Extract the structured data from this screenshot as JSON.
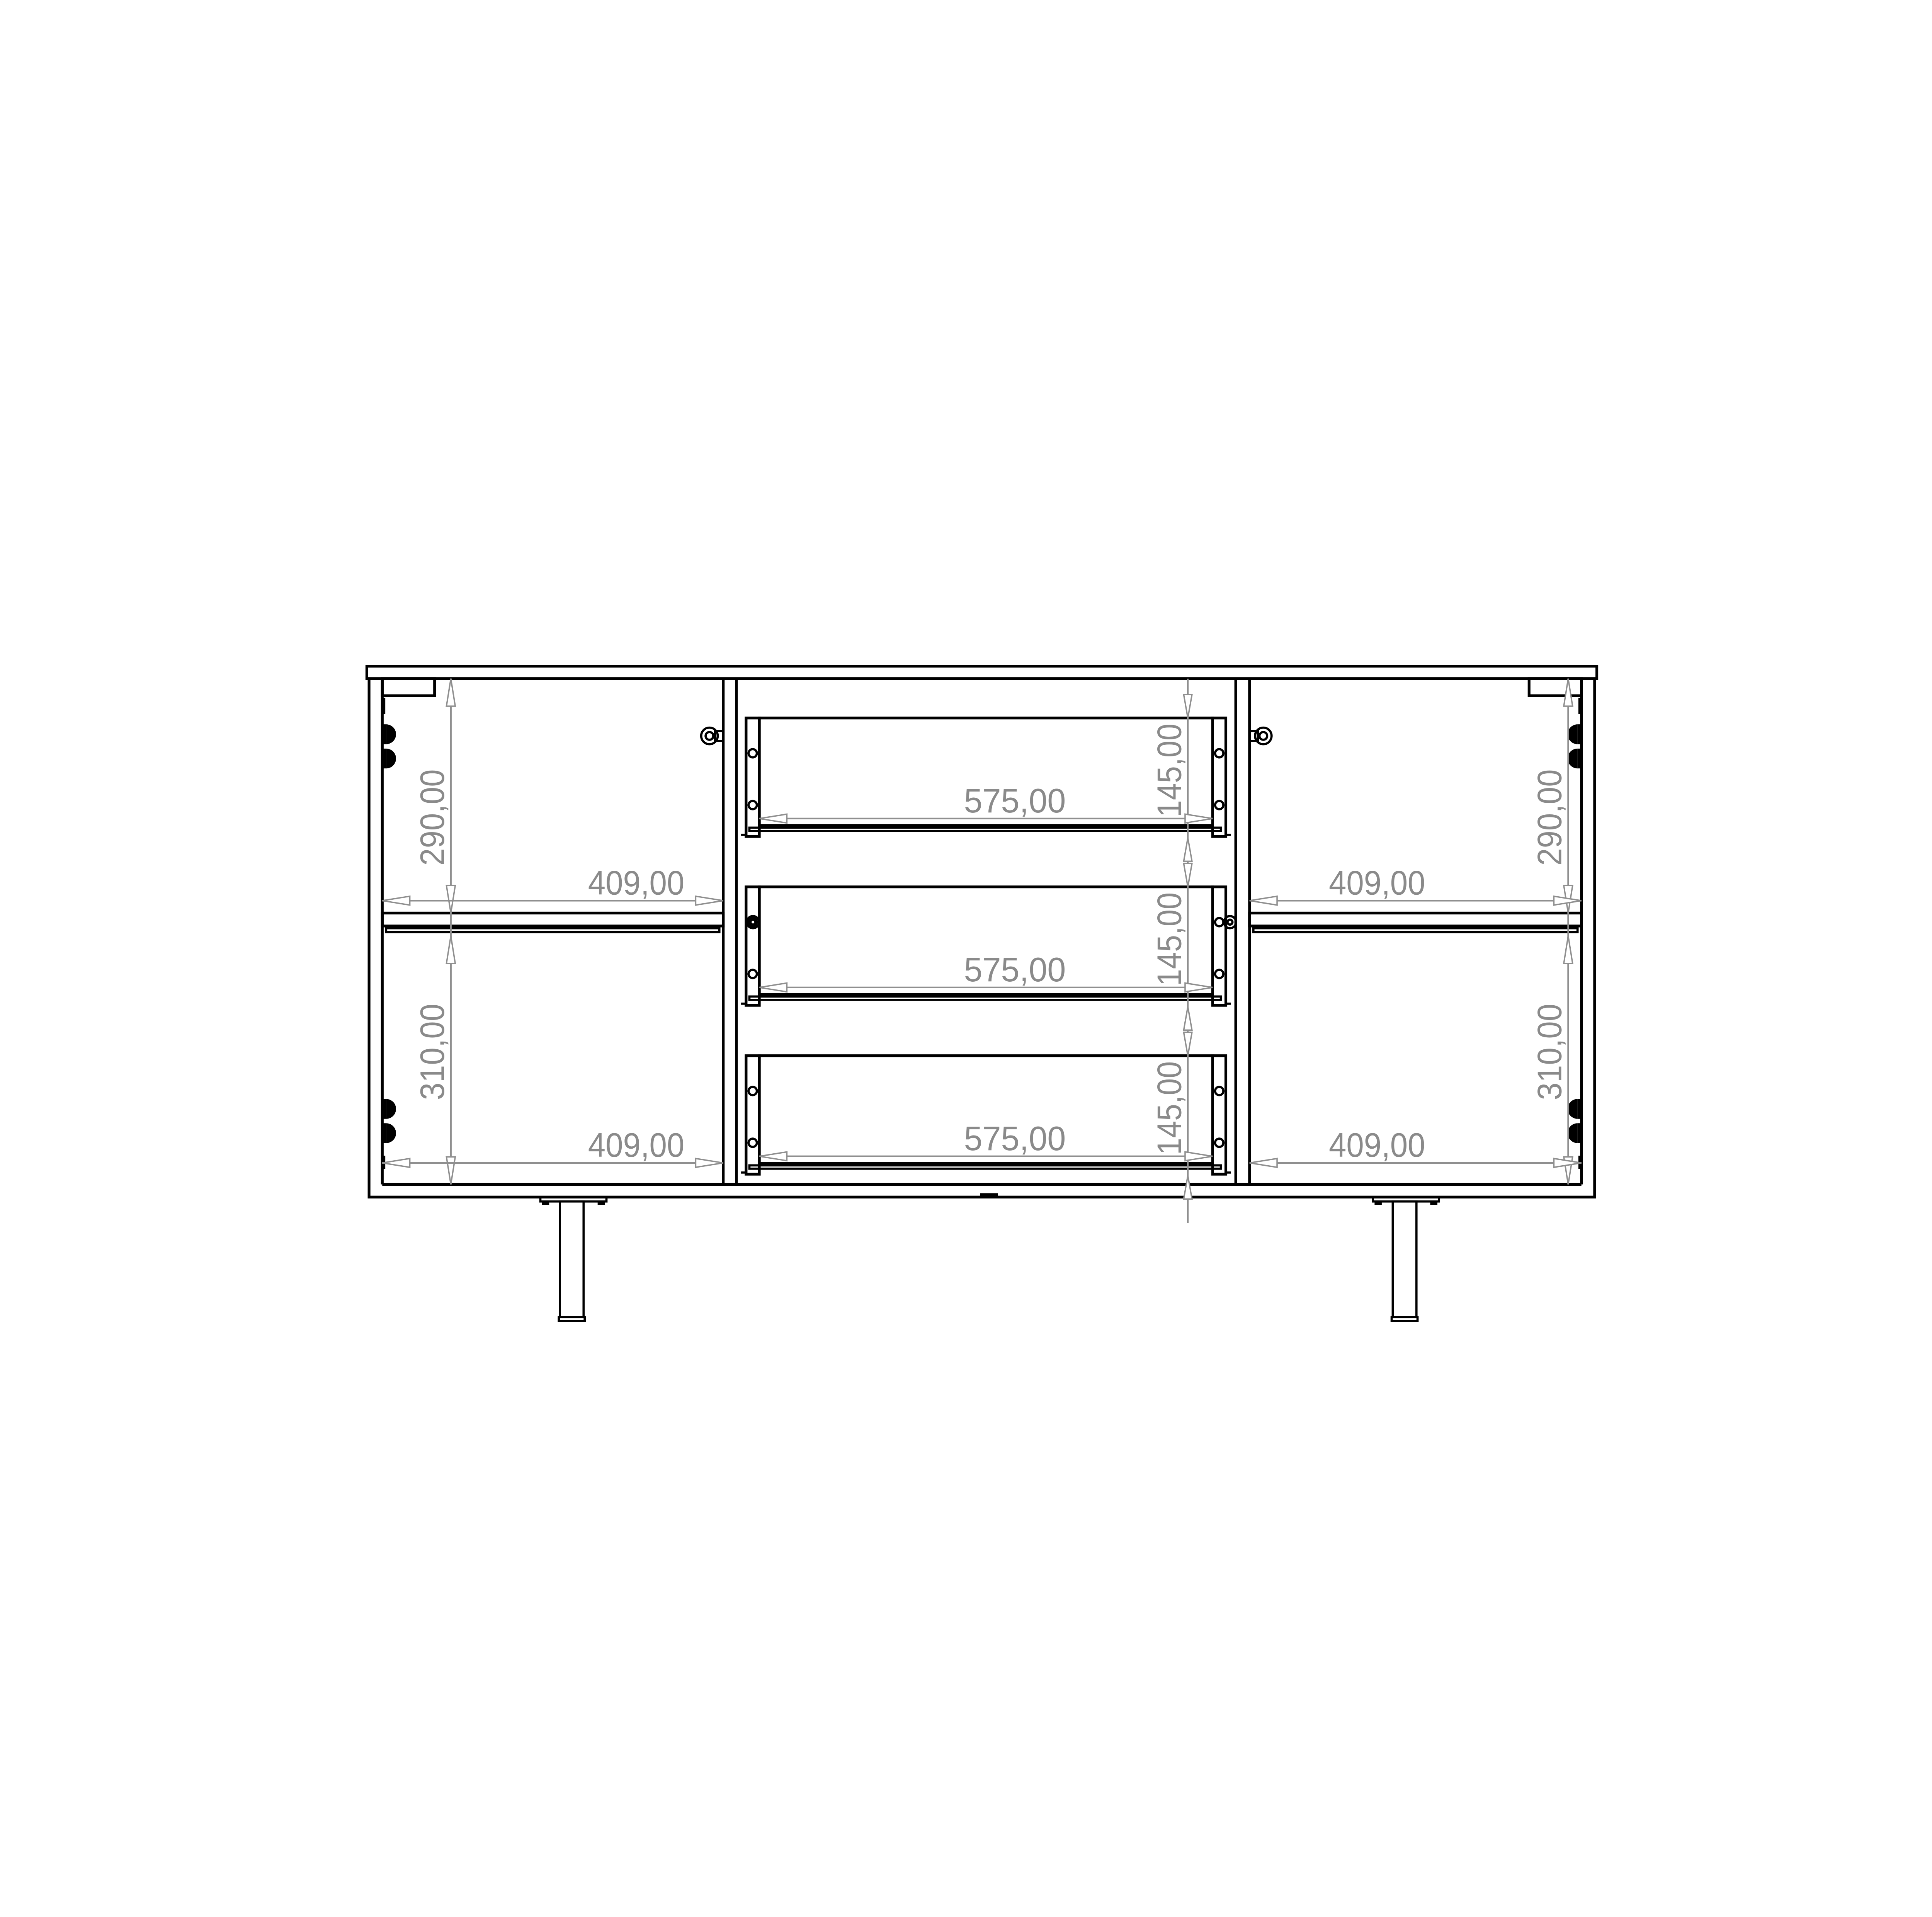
{
  "colors": {
    "background": "#ffffff",
    "geometry_line": "#000000",
    "dimension_line": "#8f8f8f",
    "dimension_text": "#8a8a8a"
  },
  "drawing": {
    "dimension_labels": {
      "left_section": {
        "upper_height": "290,00",
        "upper_width": "409,00",
        "lower_height": "310,00",
        "lower_width": "409,00"
      },
      "right_section": {
        "upper_height": "290,00",
        "upper_width": "409,00",
        "lower_height": "310,00",
        "lower_width": "409,00"
      },
      "drawers": [
        {
          "width": "575,00",
          "height": "145,00"
        },
        {
          "width": "575,00",
          "height": "145,00"
        },
        {
          "width": "575,00",
          "height": "145,00"
        }
      ]
    }
  }
}
